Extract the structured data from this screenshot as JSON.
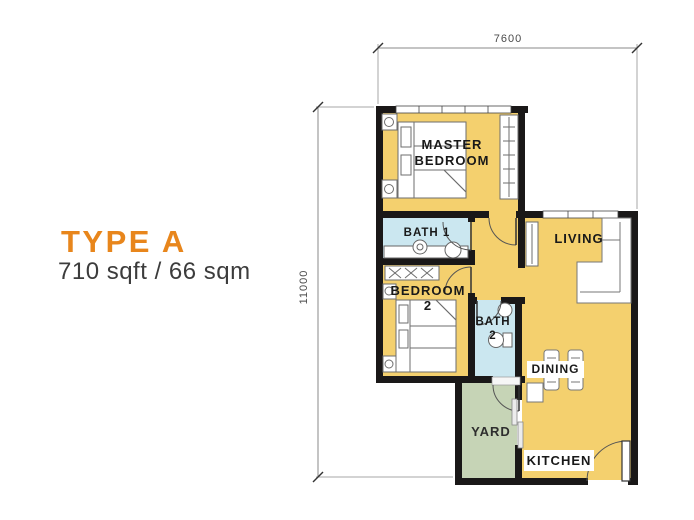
{
  "plan": {
    "title": "TYPE A",
    "subtitle": "710 sqft / 66 sqm",
    "dimensions": {
      "width": "7600",
      "height": "11000"
    },
    "rooms": {
      "master_bedroom": {
        "line1": "MASTER",
        "line2": "BEDROOM"
      },
      "bath_1": {
        "label": "BATH 1"
      },
      "living": {
        "label": "LIVING"
      },
      "bedroom_2": {
        "line1": "BEDROOM",
        "line2": "2"
      },
      "bath_2": {
        "line1": "BATH",
        "line2": "2"
      },
      "dining": {
        "label": "DINING"
      },
      "yard": {
        "label": "YARD"
      },
      "kitchen": {
        "label": "KITCHEN"
      }
    },
    "colors": {
      "accent_orange": "#E8861C",
      "floor_yellow": "#F4D06E",
      "bath_blue": "#CBE7F0",
      "yard_green": "#C6D4B6",
      "wall_black": "#1A1818"
    }
  }
}
